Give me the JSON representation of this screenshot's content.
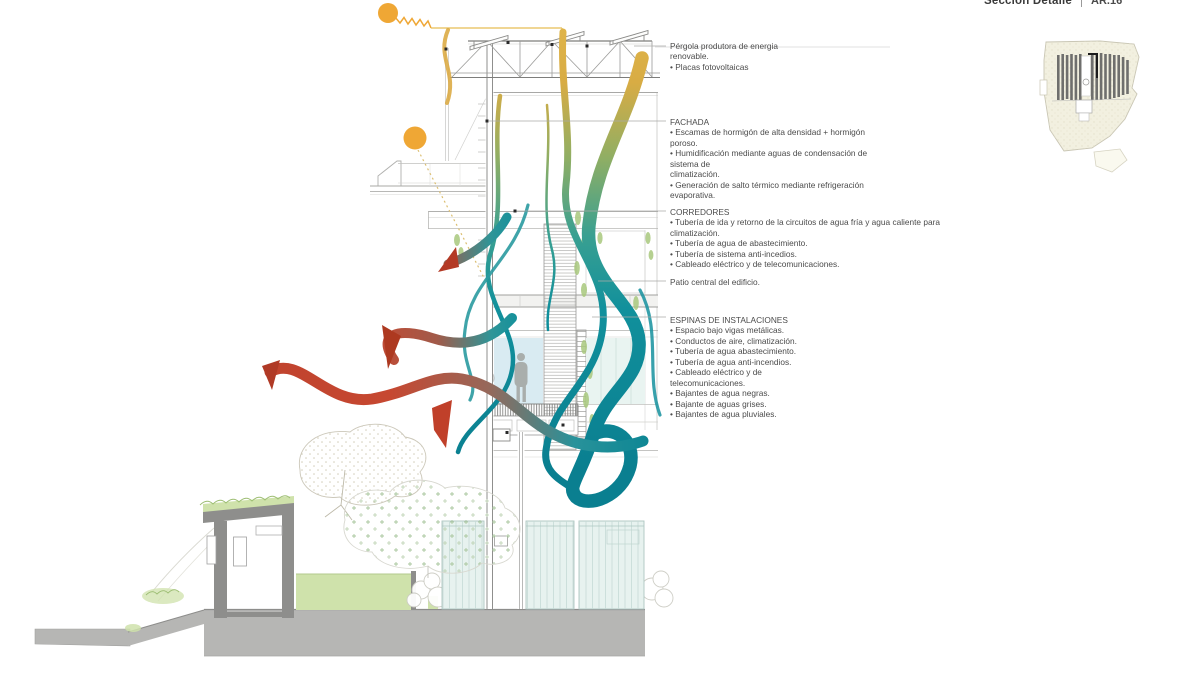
{
  "title_block": {
    "title": "Sección Detalle",
    "sheet_code": "AR.16"
  },
  "annotations": {
    "pergola": {
      "lines": [
        "Pérgola produtora de energia",
        "renovable.",
        "• Placas fotovoltaicas"
      ]
    },
    "fachada": {
      "lines": [
        "FACHADA",
        "• Escamas de hormigón de alta densidad + hormigón",
        "poroso.",
        "• Humidificación mediante aguas de condensación de",
        "sistema de",
        " climatización.",
        "• Generación de salto térmico mediante refrigeración",
        "evaporativa."
      ]
    },
    "corredores": {
      "lines": [
        "CORREDORES",
        "• Tubería de ida y retorno de la circuitos de agua fría y agua caliente para",
        "climatización.",
        "• Tubería de agua de abastecimiento.",
        "• Tubería de sistema anti-incedios.",
        "• Cableado eléctrico y de telecomunicaciones."
      ]
    },
    "patio": {
      "lines": [
        "Patio central del edificio."
      ]
    },
    "espinas": {
      "lines": [
        "ESPINAS DE INSTALACIONES",
        "• Espacio bajo vigas metálicas.",
        "• Conductos de aire, climatización.",
        "• Tubería de agua abastecimiento.",
        "• Tubería de agua anti-incendios.",
        "• Cableado eléctrico y de",
        "telecomunicaciones.",
        "• Bajantes de agua negras.",
        "• Bajante de aguas grises.",
        "• Bajantes de agua pluviales."
      ]
    }
  },
  "colors": {
    "ribbon_gold": "#dfb44a",
    "ribbon_teal": "#11909c",
    "ribbon_red": "#c64831",
    "sun_orange": "#efa735",
    "vegetation_green": "#cfe2ab",
    "ground_gray": "#b6b6b4",
    "panel_teal_tint": "#e7f2ef",
    "glass_blue": "#d9ebf2",
    "glass_blue_light": "#e9f4f1"
  }
}
